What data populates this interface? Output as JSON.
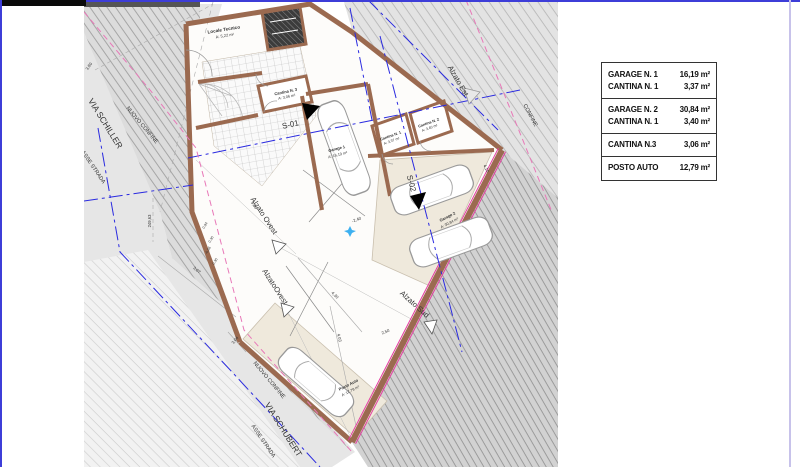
{
  "colors": {
    "wall_brown": "#9b6a50",
    "axis_blue": "#2a2ae0",
    "confine_magenta": "#e53ca0",
    "floor_beige": "#efe9dc",
    "street_gray": "#e6e6e6",
    "hatch_gray": "#dcdcdc",
    "level_marker_blue": "#3db0f0"
  },
  "legend": {
    "rows": [
      {
        "label": "GARAGE N. 1",
        "value": "16,19 m²"
      },
      {
        "label": "CANTINA N. 1",
        "value": "3,37 m²"
      },
      {
        "label": "GARAGE N. 2",
        "value": "30,84 m²"
      },
      {
        "label": "CANTINA N. 1",
        "value": "3,40 m²"
      },
      {
        "label": "CANTINA N.3",
        "value": "3,06 m²"
      },
      {
        "label": "POSTO AUTO",
        "value": "12,79 m²"
      }
    ]
  },
  "plan": {
    "rooms": [
      {
        "name": "Locale Tecnico",
        "area": "A: 5,22 m²"
      },
      {
        "name": "Cantina N. 3",
        "area": "A: 3,06 m²"
      },
      {
        "name": "Cantina N. 1",
        "area": "A: 3,37 m²"
      },
      {
        "name": "Cantina N. 2",
        "area": "A: 3,40 m²"
      },
      {
        "name": "Garage 1",
        "area": "A: 16,19 m²"
      },
      {
        "name": "Garage 2",
        "area": "A: 30,84 m²"
      },
      {
        "name": "Posto Auto",
        "area": "A: 12,79 m²"
      }
    ],
    "markers": {
      "s01": "S-01",
      "s02": "S-02",
      "alzato_ovest_1": "Alzato Ovest",
      "alzato_ovest_2": "AlzatoOvest",
      "alzato_sud": "Alzato Sud",
      "alzato_est": "Alzato Est"
    },
    "streets": {
      "via_schiller": "VIA SCHILLER",
      "via_schubert": "VIA SCHUBERT",
      "nuovo_confine_top": "NUOVO CONFINE",
      "nuovo_confine_bottom": "NUOVO CONFINE",
      "asse_strada_top": "ASSE STRADA",
      "asse_strada_bottom": "ASSE STRADA",
      "confine": "CONFINE"
    },
    "dimensions": [
      "3,60",
      "249,63",
      "3,07",
      "3,04",
      "0,94",
      "0,30",
      "-0,66",
      "0,30",
      "-2,40",
      "4,30",
      "4,03",
      "2,50",
      "4,10",
      "5,00"
    ]
  }
}
